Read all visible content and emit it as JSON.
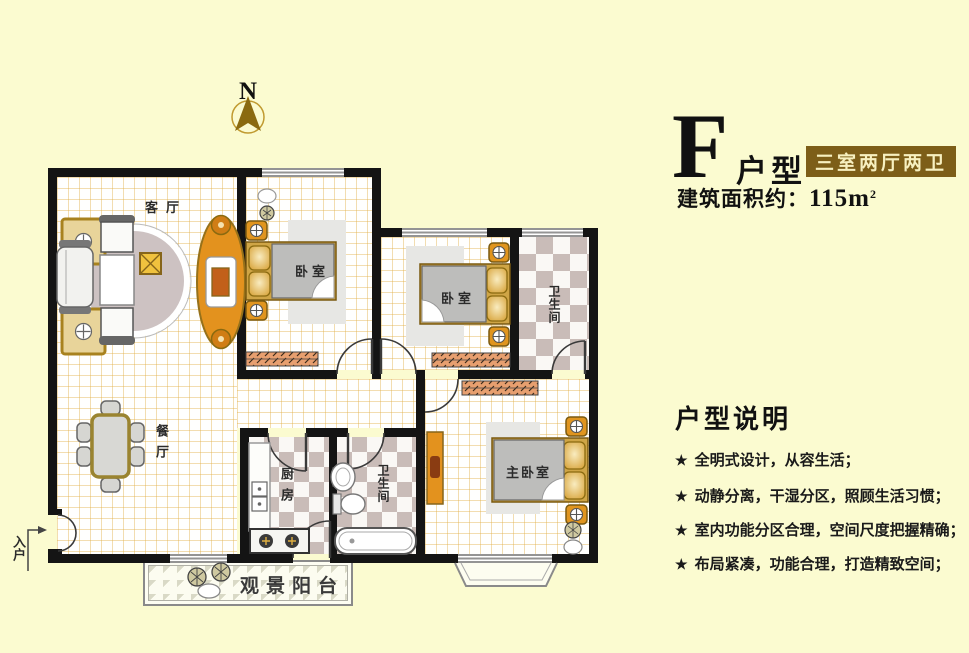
{
  "header": {
    "type_letter": "F",
    "type_suffix": "户型",
    "badge": "三室两厅两卫",
    "area_label": "建筑面积约：",
    "area_value": "115m",
    "area_sup": "2"
  },
  "compass": {
    "label": "N"
  },
  "rooms": {
    "living": "客厅",
    "dining": "餐厅",
    "bedroom1": "卧室",
    "bedroom2": "卧室",
    "master": "主卧室",
    "bath1": "卫生间",
    "bath2": "卫生间",
    "kitchen": "厨房",
    "balcony": "观景阳台",
    "entrance": "入户"
  },
  "description": {
    "title": "户型说明",
    "bullet_icon": "★",
    "items": [
      "全明式设计，从容生活；",
      "动静分离，干湿分区，照顾生活习惯；",
      "室内功能分区合理，空间尺度把握精确；",
      "布局紧凑，功能合理，打造精致空间；"
    ]
  },
  "colors": {
    "page_background": "#fbfbd0",
    "wall": "#141414",
    "badge_background": "#7d5e18",
    "badge_text": "#f7f0c0",
    "furniture_gold": "#e3921e",
    "checker_tile": "#c9bcb8",
    "blanket_gray": "#bdbdbb",
    "compass_gold": "#8a6a10"
  }
}
